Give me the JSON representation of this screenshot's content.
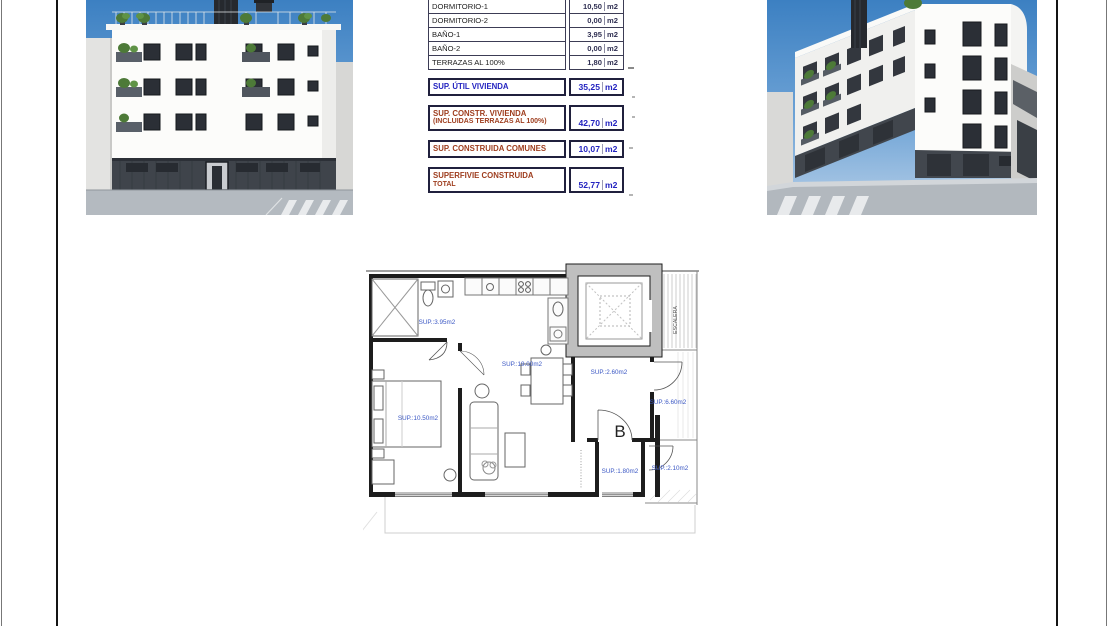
{
  "area_table": {
    "rows": [
      {
        "label": "DORMITORIO-1",
        "value": "10,50",
        "unit": "m2"
      },
      {
        "label": "DORMITORIO-2",
        "value": "0,00",
        "unit": "m2"
      },
      {
        "label": "BAÑO-1",
        "value": "3,95",
        "unit": "m2"
      },
      {
        "label": "BAÑO-2",
        "value": "0,00",
        "unit": "m2"
      },
      {
        "label": "TERRAZAS AL 100%",
        "value": "1,80",
        "unit": "m2"
      }
    ],
    "summary": [
      {
        "label": "SUP. ÚTIL VIVIENDA",
        "value": "35,25",
        "unit": "m2"
      },
      {
        "label": "SUP. CONSTR. VIVIENDA",
        "label2": "(INCLUIDAS TERRAZAS AL 100%)",
        "value": "42,70",
        "unit": "m2"
      },
      {
        "label": "SUP. CONSTRUIDA COMUNES",
        "value": "10,07",
        "unit": "m2"
      },
      {
        "label": "SUPERFIVIE CONSTRUIDA",
        "label2": "TOTAL",
        "value": "52,77",
        "unit": "m2"
      }
    ]
  },
  "floor_plan": {
    "unit_letter": "B",
    "labels": {
      "bathroom": "SUP.:3.95m2",
      "living": "SUP.:19.00m2",
      "bedroom": "SUP.:10.50m2",
      "hall": "SUP.:2.60m2",
      "terrace": "SUP.:6.60m2",
      "laundry": "SUP.:1.80m2",
      "balcony": "SUP.:2.10m2",
      "stairs": "ESCALERA"
    }
  },
  "colors": {
    "value_blue": "#2323c0",
    "label_brown": "#9e3d1e",
    "plan_label_blue": "#3a57c4",
    "sky_blue": "#3c80c2",
    "wall_black": "#1d1d1d",
    "elevator_gray": "#bfbfbf"
  }
}
